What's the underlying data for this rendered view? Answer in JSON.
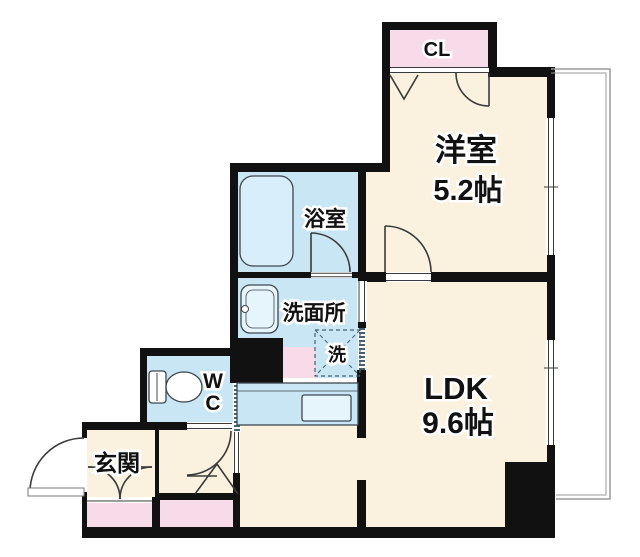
{
  "plan": {
    "rooms": {
      "closet": {
        "label": "CL"
      },
      "western_room": {
        "label": "洋室",
        "size": "5.2帖"
      },
      "bathroom": {
        "label": "浴室"
      },
      "washroom": {
        "label": "洗面所"
      },
      "laundry": {
        "label": "洗"
      },
      "toilet": {
        "label_line1": "W",
        "label_line2": "C"
      },
      "entrance": {
        "label": "玄関"
      },
      "ldk": {
        "label": "LDK",
        "size": "9.6帖"
      }
    },
    "colors": {
      "floor_cream": "#faf2df",
      "floor_blue": "#c8e6f4",
      "floor_pink": "#f8dbe9",
      "fixture_light": "#e6f4fb",
      "tub_blue": "#d9eefb",
      "wall": "#111111",
      "line": "#3a3a3a",
      "fence_gray": "#9a9a9a"
    }
  }
}
